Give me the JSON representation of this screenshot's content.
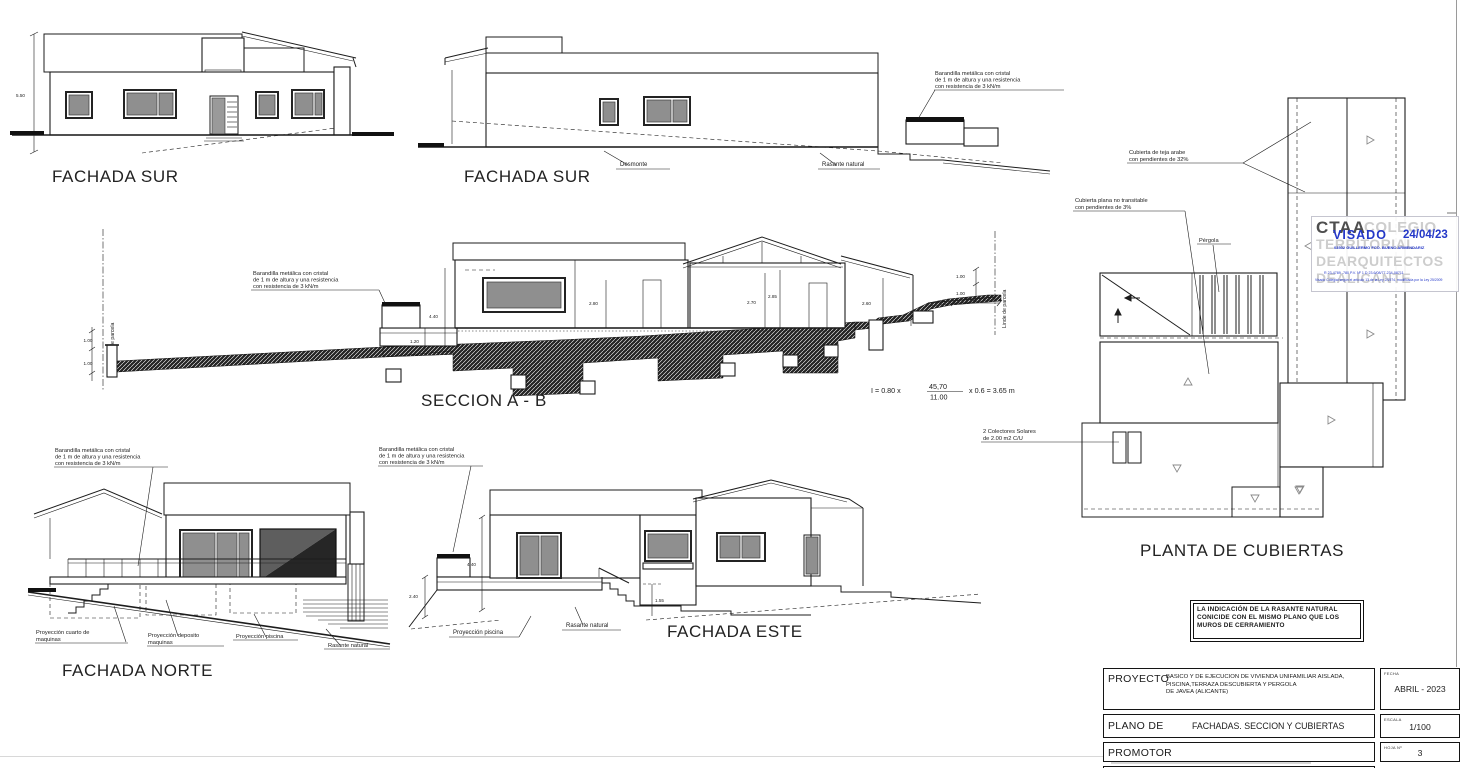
{
  "palette": {
    "ink": "#1c1c1c",
    "roof_fill": "#141414",
    "glazing": "#8f8f8f",
    "stamp_blue": "#2438c8",
    "watermark_gray": "#cdcdcd"
  },
  "shared": {
    "barandilla_l1": "Barandilla metálica con cristal",
    "barandilla_l2": "de 1 m de altura y una resistencia",
    "barandilla_l3": "con resistencia de 3 kN/m"
  },
  "fachada_sur_1": {
    "title": "FACHADA SUR",
    "dim_height": "5.50"
  },
  "fachada_sur_2": {
    "title": "FACHADA SUR",
    "label_desmonte": "Desmonte",
    "label_rasante": "Rasante natural"
  },
  "seccion": {
    "title": "SECCION A - B",
    "linde": "Linde de parcela",
    "dims": {
      "d100a": "1.00",
      "d100b": "1.00",
      "d440": "4.40",
      "d120": "1.20",
      "d280": "2.80",
      "d270": "2.70",
      "d285": "2.85",
      "d260": "2.60",
      "d060": "0.60",
      "d365": "3.65",
      "d100c": "1.00",
      "d100d": "1.00"
    },
    "formula": {
      "lhs": "I = 0.80 x",
      "num": "45,70",
      "den": "11.00",
      "rhs": "x 0.6 = 3.65 m"
    }
  },
  "fachada_norte": {
    "title": "FACHADA NORTE",
    "proy_cuarto_l1": "Proyección cuarto de",
    "proy_cuarto_l2": "maquinas",
    "proy_deposito_l1": "Proyección deposito",
    "proy_deposito_l2": "maquinas",
    "proy_piscina": "Proyección piscina",
    "label_rasante": "Rasante natural"
  },
  "fachada_este": {
    "title": "FACHADA ESTE",
    "proy_piscina": "Proyección piscina",
    "label_rasante": "Rasante natural",
    "dims": {
      "d240": "2.40",
      "d440": "4.40",
      "d155": "1.55"
    }
  },
  "cubiertas": {
    "title": "PLANTA DE CUBIERTAS",
    "teja_l1": "Cubierta de teja arabe",
    "teja_l2": "con pendientes de 32%",
    "plana_l1": "Cubierta plana no transitable",
    "plana_l2": "con pendientes de 3%",
    "pergola": "Pérgola",
    "colectores_l1": "2 Colectores Solares",
    "colectores_l2": "de 2.00 m2 C/U"
  },
  "stamp": {
    "org_acronym": "CTAA",
    "wm_l1": "COLEGIO",
    "wm_l2": "TERRITORIAL",
    "wm_l3": "DEARQUITECTOS",
    "wm_l4": "DEALICANTE",
    "visado": "VISADO",
    "fecha": "24/04/23",
    "colegiado": "03502 GUILLERMO FCO. BUENO ARMENDARIZ",
    "small_1": "R 23-4789 -780    P.V. Nº 1    D 23.6/08/77-234-08711",
    "small_2": "Visado Colegial según el artículo 13 de la Ley 2/1974, modificada por la Ley 25/2009"
  },
  "nota": {
    "l1": "LA INDICACIÓN DE LA RASANTE NATURAL",
    "l2": "CONICIDE  CON EL MISMO PLANO QUE LOS",
    "l3": "MUROS DE CERRAMIENTO"
  },
  "title_block": {
    "proyecto_label": "PROYECTO",
    "proyecto_l1": "BASICO  Y  DE EJECUCION  DE  VIVIENDA  UNIFAMILIAR  AISLADA,",
    "proyecto_l2": "PISCINA,TERRAZA DESCUBIERTA Y PERGOLA",
    "proyecto_l3": "DE JAVEA (ALICANTE)",
    "fecha_label": "FECHA",
    "fecha_value": "ABRIL - 2023",
    "plano_label": "PLANO DE",
    "plano_value": "FACHADAS. SECCION Y CUBIERTAS",
    "escala_label": "ESCALA",
    "escala_value": "1/100",
    "promotor_label": "PROMOTOR",
    "hoja_label": "HOJA Nº",
    "hoja_value": "3",
    "arquitectos_label": "ARQUITECTOS"
  }
}
